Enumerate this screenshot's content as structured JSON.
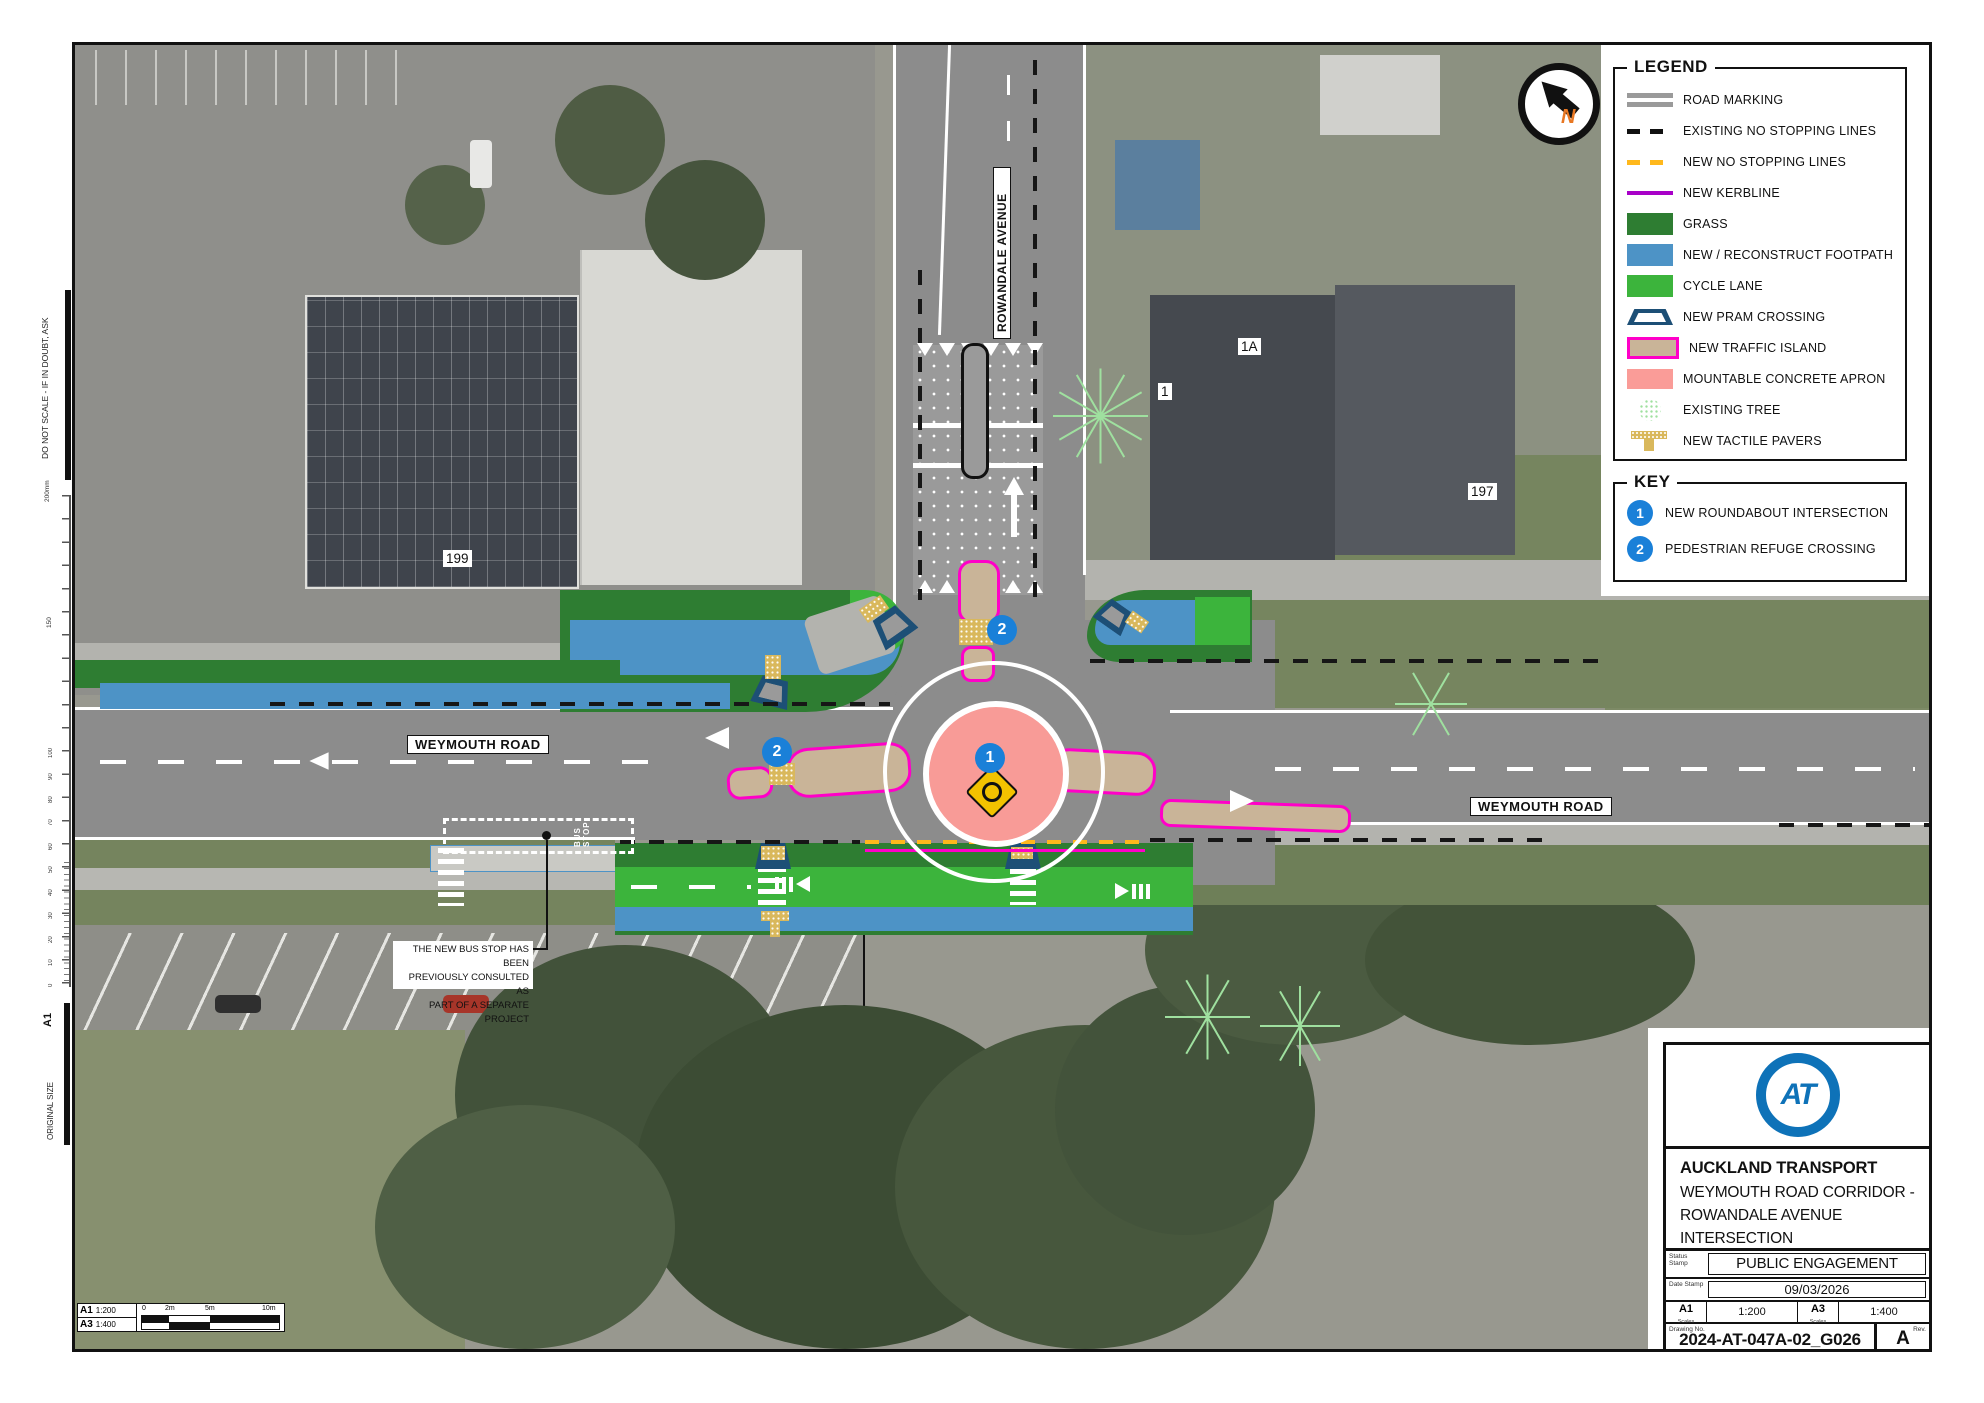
{
  "colors": {
    "grass": "#2e7d32",
    "footpath": "#4d93c6",
    "cycle_lane": "#3cb43c",
    "pram_crossing": "#1d4f76",
    "traffic_island_fill": "#c9b498",
    "traffic_island_border": "#ff00c8",
    "concrete_apron": "#f89b97",
    "existing_tree": "#9fe09f",
    "tactile_pavers": "#d9b85c",
    "no_stopping_existing": "#161616",
    "no_stopping_new": "#ffb81c",
    "kerbline": "#a800c8",
    "key_badge": "#1a80d8",
    "logo_blue": "#0e72b8",
    "north_orange": "#e87722"
  },
  "left_margin": {
    "do_not_scale": "DO NOT SCALE - IF IN DOUBT, ASK",
    "ruler_top": "200mm",
    "ruler_150": "150",
    "ruler_numbers": [
      "100",
      "90",
      "80",
      "70",
      "60",
      "50",
      "40",
      "30",
      "20",
      "10",
      "0"
    ],
    "original_size": "ORIGINAL SIZE",
    "sheet_size": "A1"
  },
  "legend": {
    "title": "LEGEND",
    "items": [
      {
        "label": "ROAD MARKING",
        "swatch": "road-marking"
      },
      {
        "label": "EXISTING NO STOPPING LINES",
        "swatch": "dash-black"
      },
      {
        "label": "NEW NO STOPPING LINES",
        "swatch": "dash-orange"
      },
      {
        "label": "NEW KERBLINE",
        "swatch": "line-purple"
      },
      {
        "label": "GRASS",
        "swatch": "fill-grass"
      },
      {
        "label": "NEW / RECONSTRUCT FOOTPATH",
        "swatch": "fill-footpath"
      },
      {
        "label": "CYCLE LANE",
        "swatch": "fill-cycle"
      },
      {
        "label": "NEW PRAM CROSSING",
        "swatch": "pram"
      },
      {
        "label": "NEW TRAFFIC ISLAND",
        "swatch": "island"
      },
      {
        "label": "MOUNTABLE CONCRETE APRON",
        "swatch": "fill-apron"
      },
      {
        "label": "EXISTING TREE",
        "swatch": "tree"
      },
      {
        "label": "NEW TACTILE PAVERS",
        "swatch": "tactile"
      }
    ]
  },
  "key": {
    "title": "KEY",
    "items": [
      {
        "num": "1",
        "label": "NEW ROUNDABOUT INTERSECTION"
      },
      {
        "num": "2",
        "label": "PEDESTRIAN REFUGE CROSSING"
      }
    ]
  },
  "map": {
    "labels": {
      "weymouth_west": "WEYMOUTH ROAD",
      "weymouth_east": "WEYMOUTH ROAD",
      "rowandale": "ROWANDALE AVENUE"
    },
    "properties": {
      "n199": "199",
      "n1": "1",
      "n1a": "1A",
      "n197": "197"
    },
    "markers": {
      "roundabout": "1",
      "refuge_west": "2",
      "refuge_north": "2"
    },
    "north": "N",
    "bus_stop_marking": "BUS STOP",
    "note_lines": [
      "THE NEW BUS STOP HAS BEEN",
      "PREVIOUSLY CONSULTED AS",
      "PART OF A SEPARATE PROJECT"
    ]
  },
  "title_block": {
    "logo_text": "AT",
    "company": "AUCKLAND TRANSPORT",
    "project_lines": [
      "WEYMOUTH ROAD CORRIDOR -",
      "ROWANDALE AVENUE",
      "INTERSECTION"
    ],
    "status_label": "Status Stamp",
    "status_value": "PUBLIC ENGAGEMENT",
    "date_label": "Date Stamp",
    "date_value": "09/03/2026",
    "a1_label": "A1",
    "a3_label": "A3",
    "scales_caption": "Scales",
    "a1_value": "1:200",
    "a3_value": "1:400",
    "drawing_label": "Drawing No.",
    "drawing_value": "2024-AT-047A-02_G026",
    "rev_label": "Rev.",
    "rev_value": "A"
  },
  "scale_bar": {
    "a1": "A1",
    "a1_scale": "1:200",
    "a3": "A3",
    "a3_scale": "1:400",
    "ticks": [
      "0",
      "2m",
      "5m",
      "10m"
    ]
  }
}
